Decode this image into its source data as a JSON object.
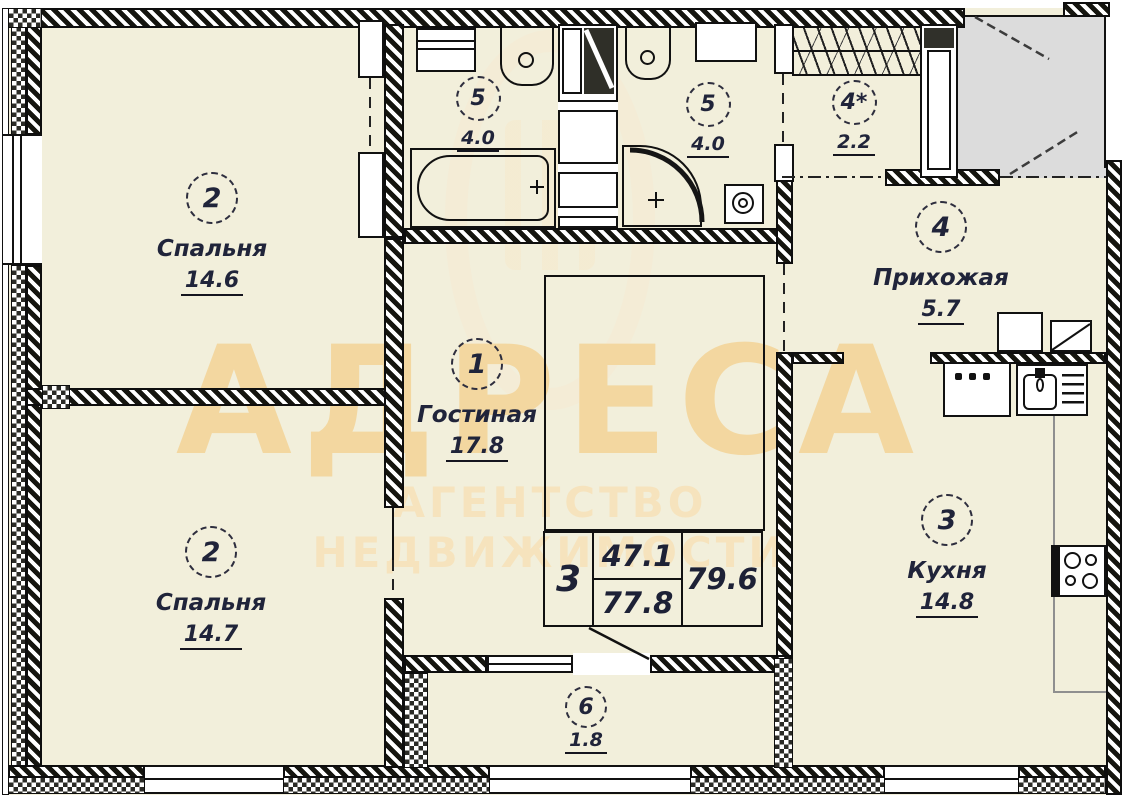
{
  "plan": {
    "watermark": {
      "title": "АДРЕСА",
      "subtitle": "АГЕНТСТВО НЕДВИЖИМОСТИ"
    },
    "rooms": {
      "living": {
        "number": "1",
        "name": "Гостиная",
        "area": "17.8"
      },
      "bedroom_top": {
        "number": "2",
        "name": "Спальня",
        "area": "14.6"
      },
      "bedroom_bottom": {
        "number": "2",
        "name": "Спальня",
        "area": "14.7"
      },
      "kitchen": {
        "number": "3",
        "name": "Кухня",
        "area": "14.8"
      },
      "hallway": {
        "number": "4",
        "name": "Прихожая",
        "area": "5.7"
      },
      "wardrobe": {
        "number": "4*",
        "area": "2.2"
      },
      "bathroom_left": {
        "number": "5",
        "area": "4.0"
      },
      "bathroom_right": {
        "number": "5",
        "area": "4.0"
      },
      "balcony": {
        "number": "6",
        "area": "1.8"
      }
    },
    "stamp": {
      "rooms_count": "3",
      "living_area": "47.1",
      "apartment_area": "77.8",
      "total_area": "79.6"
    },
    "colors": {
      "floor": "#f2efdb",
      "landing": "#dcdcdc",
      "ink": "#20243a",
      "watermark": "#f4d9a6"
    }
  }
}
